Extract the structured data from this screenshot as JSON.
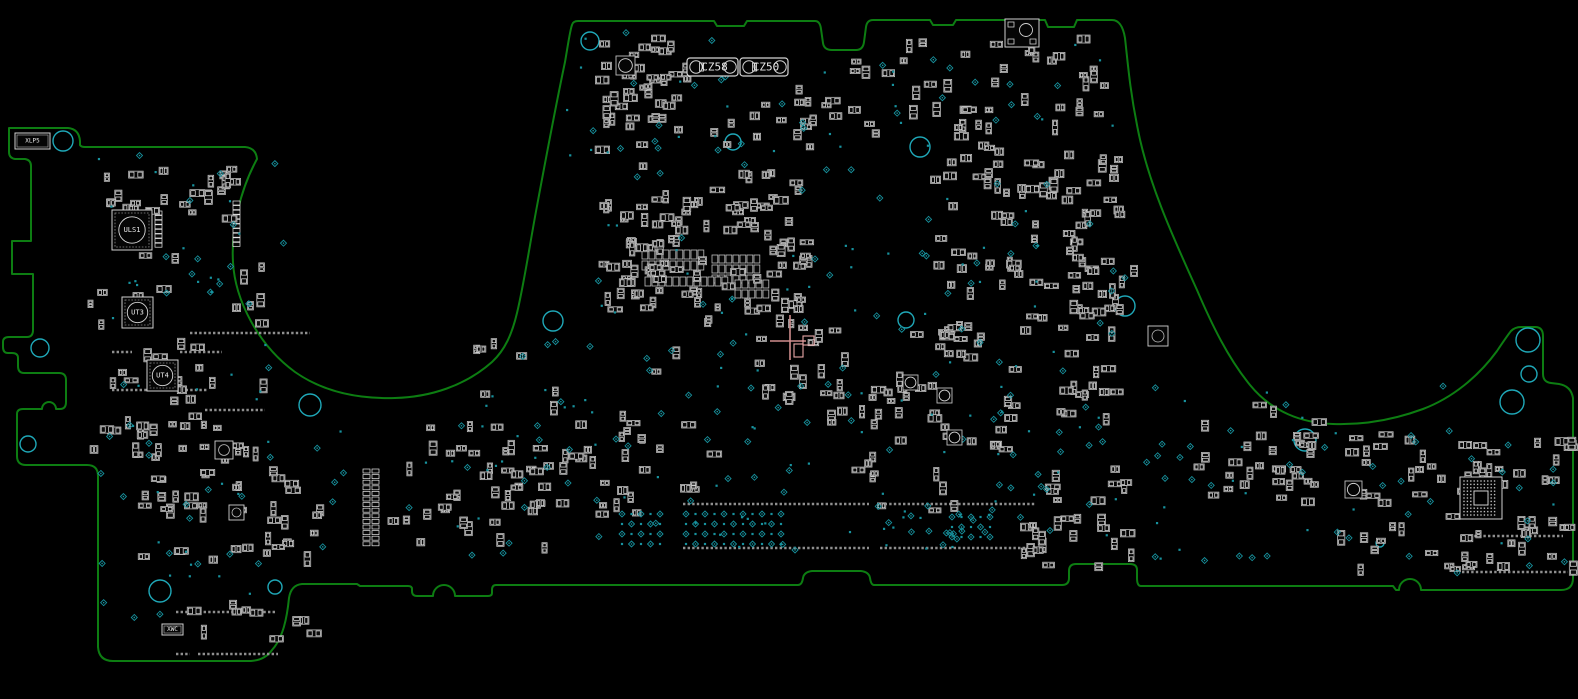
{
  "app": {
    "background": "#000000"
  },
  "colors": {
    "outline": "#0d7d12",
    "component": "#bdbdbd",
    "pad": "#e8e8e8",
    "comp_fill": "#050505",
    "testpoint": "#17929e",
    "hole": "#1fa8b8",
    "padrow": "#8f8f8f",
    "selection": "#cf8d8d",
    "label": "#e9e9e9"
  },
  "board": {
    "outline_path": "M 9,128 H 68 Q 79,129 80,141 L 80,145 Q 81,147 85,147 H 245 Q 256,148 257,159 C 240,190 231,230 233,262 C 235,300 258,345 295,372 C 325,393 360,399 395,398 C 430,397 465,386 492,362 C 505,350 512,334 517,313 C 524,284 530,243 537,206 C 545,163 557,100 565,62 C 568,45 570,30 572,25 Q 573,21 578,21 H 714 L 717,26 H 744 L 747,21 H 815 Q 820,21 821,29 L 823,43 Q 824,50 832,50 H 856 Q 863,50 864,42 L 866,27 Q 867,20 873,20 H 930 L 933,25 H 953 L 956,20 H 1045 L 1048,27 H 1074 L 1077,20 H 1112 Q 1122,20 1125,38 C 1128,65 1130,90 1137,125 C 1147,180 1172,235 1197,290 C 1212,325 1228,358 1250,385 C 1272,412 1302,423 1333,424 C 1362,425 1393,420 1423,409 C 1452,398 1478,377 1497,351 Q 1507,336 1511,331 Q 1515,327 1521,327 H 1535 Q 1543,327 1543,336 V 374 Q 1543,382 1551,383 L 1559,384 Q 1571,386 1573,398 V 578 Q 1573,590 1561,590 H 1427 L 1421,590 a 11,11 0 0 0 -22,0 L 1396,590 L 1393,586 H 1141 Q 1137,586 1137,578 V 570 Q 1137,564 1130,564 H 1076 Q 1069,564 1069,571 V 578 Q 1069,585 1062,585 H 874 Q 871,585 870,578 Q 869,572 861,571 H 812 Q 804,572 803,578 Q 802,585 798,585 H 496 Q 492,585 492,590 V 593 Q 492,596 488,596 H 457 L 455,596 a 11,11 0 0 0 -22,0 L 431,596 H 417 Q 412,596 412,591 L 412,589 Q 412,586 408,586 H 360 L 357,584 H 302 Q 291,585 289,598 C 287,618 283,638 272,650 Q 265,660 251,661 H 113 Q 99,661 98,647 V 476 Q 98,465 87,465 H 26 Q 17,465 17,456 V 414 Q 17,409 23,409 H 42 a 7,7 0 0 1 14,0 H 60 Q 66,409 66,402 V 380 Q 66,373 59,373 H 24 Q 18,373 18,366 V 358 Q 18,353 12,353 H 8 Q 3,353 3,347 V 342 Q 3,337 9,337 H 27 Q 33,337 33,330 V 274 H 12 V 241 H 31 V 166 Q 31,160 25,159 H 15 Q 9,158 9,152 Z",
    "stroke_width": 2
  },
  "mounting_holes": [
    {
      "x": 63,
      "y": 141,
      "r": 10
    },
    {
      "x": 310,
      "y": 405,
      "r": 11
    },
    {
      "x": 553,
      "y": 321,
      "r": 10
    },
    {
      "x": 590,
      "y": 41,
      "r": 9
    },
    {
      "x": 733,
      "y": 142,
      "r": 8
    },
    {
      "x": 920,
      "y": 147,
      "r": 10
    },
    {
      "x": 906,
      "y": 320,
      "r": 8
    },
    {
      "x": 1125,
      "y": 306,
      "r": 10
    },
    {
      "x": 1305,
      "y": 440,
      "r": 11
    },
    {
      "x": 1528,
      "y": 340,
      "r": 12
    },
    {
      "x": 1529,
      "y": 374,
      "r": 8
    },
    {
      "x": 1512,
      "y": 402,
      "r": 12
    },
    {
      "x": 160,
      "y": 591,
      "r": 11
    },
    {
      "x": 275,
      "y": 587,
      "r": 7
    },
    {
      "x": 40,
      "y": 348,
      "r": 9
    },
    {
      "x": 28,
      "y": 444,
      "r": 8
    },
    {
      "x": 1380,
      "y": 543,
      "r": 4
    }
  ],
  "labeled_components": [
    {
      "id": "CZ58",
      "type": "cz",
      "x": 687,
      "y": 58,
      "w": 51,
      "h": 18
    },
    {
      "id": "CZ50",
      "type": "cz",
      "x": 740,
      "y": 58,
      "w": 48,
      "h": 18
    },
    {
      "id": "ULS1",
      "type": "qfn",
      "x": 112,
      "y": 210,
      "w": 40,
      "h": 40
    },
    {
      "id": "UT3",
      "type": "qfn",
      "x": 122,
      "y": 297,
      "w": 31,
      "h": 31
    },
    {
      "id": "UT4",
      "type": "qfn",
      "x": 147,
      "y": 360,
      "w": 31,
      "h": 31
    },
    {
      "id": "XLP5",
      "type": "xconn",
      "x": 15,
      "y": 133,
      "w": 35,
      "h": 16
    },
    {
      "id": "XWC",
      "type": "xconn",
      "x": 162,
      "y": 624,
      "w": 21,
      "h": 11
    },
    {
      "id": "",
      "type": "boxcircle",
      "x": 1005,
      "y": 19,
      "w": 34,
      "h": 28
    },
    {
      "id": "",
      "type": "bga",
      "x": 1460,
      "y": 477,
      "w": 42,
      "h": 42
    },
    {
      "id": "",
      "type": "smallqfn",
      "x": 215,
      "y": 441,
      "w": 18,
      "h": 18
    },
    {
      "id": "",
      "type": "smallqfn",
      "x": 1148,
      "y": 326,
      "w": 20,
      "h": 20
    },
    {
      "id": "",
      "type": "smallqfn",
      "x": 229,
      "y": 505,
      "w": 15,
      "h": 15
    }
  ],
  "circle_squares": [
    {
      "x": 616,
      "y": 56,
      "w": 19
    },
    {
      "x": 903,
      "y": 375,
      "w": 15
    },
    {
      "x": 937,
      "y": 388,
      "w": 15
    },
    {
      "x": 947,
      "y": 430,
      "w": 15
    },
    {
      "x": 1345,
      "y": 481,
      "w": 17
    }
  ],
  "pad_grids": [
    {
      "x": 642,
      "y": 250,
      "cols": 9,
      "rows": 2,
      "cw": 7,
      "ch": 9
    },
    {
      "x": 712,
      "y": 255,
      "cols": 7,
      "rows": 3,
      "cw": 7,
      "ch": 8
    },
    {
      "x": 645,
      "y": 277,
      "cols": 12,
      "rows": 1,
      "cw": 7,
      "ch": 9
    },
    {
      "x": 735,
      "y": 280,
      "cols": 5,
      "rows": 2,
      "cw": 7,
      "ch": 8
    }
  ],
  "pin_columns": [
    {
      "x": 363,
      "y": 469,
      "n": 14,
      "dy": 5.6
    },
    {
      "x": 372,
      "y": 469,
      "n": 14,
      "dy": 5.6
    },
    {
      "x": 155,
      "y": 211,
      "n": 8,
      "dy": 4.6
    },
    {
      "x": 233,
      "y": 201,
      "n": 10,
      "dy": 4.6
    }
  ],
  "pad_rows": [
    {
      "x": 683,
      "y": 504,
      "len": 186
    },
    {
      "x": 880,
      "y": 504,
      "len": 156
    },
    {
      "x": 683,
      "y": 548,
      "len": 186
    },
    {
      "x": 880,
      "y": 548,
      "len": 156
    },
    {
      "x": 176,
      "y": 612,
      "len": 100
    },
    {
      "x": 176,
      "y": 654,
      "len": 14
    },
    {
      "x": 198,
      "y": 654,
      "len": 80
    },
    {
      "x": 1465,
      "y": 536,
      "len": 98
    },
    {
      "x": 1462,
      "y": 572,
      "len": 106
    },
    {
      "x": 190,
      "y": 333,
      "len": 120
    },
    {
      "x": 112,
      "y": 352,
      "len": 20
    },
    {
      "x": 180,
      "y": 352,
      "len": 42
    },
    {
      "x": 112,
      "y": 390,
      "len": 96
    },
    {
      "x": 205,
      "y": 410,
      "len": 60
    }
  ],
  "passive_clusters": [
    {
      "x": 595,
      "y": 35,
      "w": 90,
      "h": 95,
      "n": 40,
      "seed": 11
    },
    {
      "x": 690,
      "y": 85,
      "w": 140,
      "h": 115,
      "n": 22,
      "seed": 12
    },
    {
      "x": 595,
      "y": 195,
      "w": 215,
      "h": 125,
      "n": 95,
      "seed": 13
    },
    {
      "x": 755,
      "y": 320,
      "w": 150,
      "h": 100,
      "n": 30,
      "seed": 14
    },
    {
      "x": 845,
      "y": 30,
      "w": 260,
      "h": 95,
      "n": 40,
      "seed": 15
    },
    {
      "x": 930,
      "y": 150,
      "w": 185,
      "h": 185,
      "n": 75,
      "seed": 16
    },
    {
      "x": 1055,
      "y": 255,
      "w": 80,
      "h": 200,
      "n": 25,
      "seed": 17
    },
    {
      "x": 95,
      "y": 160,
      "w": 140,
      "h": 55,
      "n": 25,
      "seed": 18
    },
    {
      "x": 85,
      "y": 250,
      "w": 180,
      "h": 210,
      "n": 55,
      "seed": 19
    },
    {
      "x": 130,
      "y": 460,
      "w": 190,
      "h": 100,
      "n": 40,
      "seed": 20
    },
    {
      "x": 385,
      "y": 440,
      "w": 180,
      "h": 105,
      "n": 40,
      "seed": 21
    },
    {
      "x": 555,
      "y": 420,
      "w": 170,
      "h": 100,
      "n": 25,
      "seed": 22
    },
    {
      "x": 1020,
      "y": 465,
      "w": 110,
      "h": 100,
      "n": 28,
      "seed": 23
    },
    {
      "x": 1190,
      "y": 400,
      "w": 130,
      "h": 100,
      "n": 32,
      "seed": 24
    },
    {
      "x": 1335,
      "y": 430,
      "w": 240,
      "h": 145,
      "n": 65,
      "seed": 25
    },
    {
      "x": 895,
      "y": 330,
      "w": 115,
      "h": 130,
      "n": 26,
      "seed": 26
    },
    {
      "x": 420,
      "y": 330,
      "w": 280,
      "h": 110,
      "n": 14,
      "seed": 27
    },
    {
      "x": 560,
      "y": 120,
      "w": 560,
      "h": 80,
      "n": 25,
      "seed": 28
    },
    {
      "x": 840,
      "y": 450,
      "w": 120,
      "h": 60,
      "n": 10,
      "seed": 29
    },
    {
      "x": 160,
      "y": 600,
      "w": 150,
      "h": 45,
      "n": 10,
      "seed": 30
    }
  ],
  "testpoint_clusters": [
    {
      "x": 95,
      "y": 155,
      "w": 190,
      "h": 480,
      "n": 70,
      "seed": 41
    },
    {
      "x": 565,
      "y": 30,
      "w": 550,
      "h": 170,
      "n": 60,
      "seed": 42
    },
    {
      "x": 585,
      "y": 210,
      "w": 540,
      "h": 245,
      "n": 110,
      "seed": 43
    },
    {
      "x": 620,
      "y": 460,
      "w": 500,
      "h": 90,
      "n": 40,
      "seed": 44
    },
    {
      "x": 1145,
      "y": 385,
      "w": 420,
      "h": 190,
      "n": 60,
      "seed": 45
    },
    {
      "x": 305,
      "y": 405,
      "w": 295,
      "h": 155,
      "n": 30,
      "seed": 46
    },
    {
      "x": 480,
      "y": 330,
      "w": 120,
      "h": 120,
      "n": 10,
      "seed": 47
    },
    {
      "x": 875,
      "y": 508,
      "w": 130,
      "h": 45,
      "n": 20,
      "seed": 48
    }
  ],
  "testpoint_grids": [
    {
      "x": 686,
      "y": 514,
      "cols": 11,
      "rows": 4,
      "dx": 9.5,
      "dy": 10
    },
    {
      "x": 622,
      "y": 514,
      "cols": 5,
      "rows": 4,
      "dx": 9.5,
      "dy": 10
    },
    {
      "x": 952,
      "y": 517,
      "cols": 5,
      "rows": 3,
      "dx": 9.5,
      "dy": 10
    }
  ],
  "selection": {
    "cross_x": 790,
    "cross_y": 341,
    "h_line": {
      "x1": 770,
      "x2": 806,
      "y": 341
    },
    "v_line": {
      "x": 790,
      "y1": 315,
      "y2": 360
    },
    "boxes": [
      {
        "x": 794,
        "y": 344,
        "w": 9,
        "h": 13
      },
      {
        "x": 803,
        "y": 336,
        "w": 11,
        "h": 9
      }
    ]
  }
}
